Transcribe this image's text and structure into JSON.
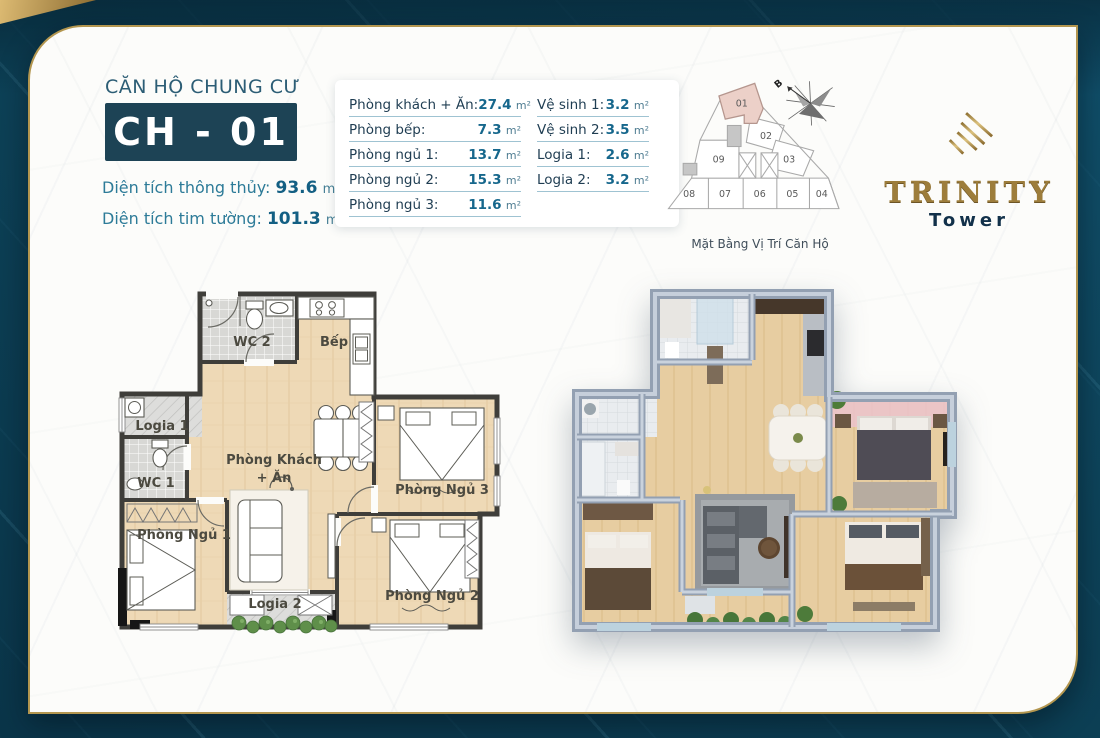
{
  "colors": {
    "background_teal": "#0c3e54",
    "card_white": "#fcfcfa",
    "brand_gold": "#b3964f",
    "navy_badge": "#1d4355",
    "teal_value": "#16678c",
    "navy_label": "#1f3d52",
    "highlight_unit_pink": "#ecd0c8",
    "plan_floor_beige": "#eed9b6",
    "plan_wall_gray": "#3f3e3a",
    "render_wall_blue": "#93a0b2"
  },
  "header": {
    "title": "CĂN HỘ CHUNG CƯ",
    "unit_code": "CH - 01",
    "net_label": "Diện tích thông thủy:",
    "net_value": "93.6",
    "gross_label": "Diện tích tim tường:",
    "gross_value": "101.3",
    "unit": "m²"
  },
  "area_table": {
    "unit": "m²",
    "left": [
      {
        "label": "Phòng khách + Ăn:",
        "value": "27.4"
      },
      {
        "label": "Phòng bếp:",
        "value": "7.3"
      },
      {
        "label": "Phòng ngủ 1:",
        "value": "13.7"
      },
      {
        "label": "Phòng ngủ 2:",
        "value": "15.3"
      },
      {
        "label": "Phòng ngủ 3:",
        "value": "11.6"
      }
    ],
    "right": [
      {
        "label": "Vệ sinh 1:",
        "value": "3.2"
      },
      {
        "label": "Vệ sinh 2:",
        "value": "3.5"
      },
      {
        "label": "Logia 1:",
        "value": "2.6"
      },
      {
        "label": "Logia 2:",
        "value": "3.2"
      }
    ]
  },
  "location_diagram": {
    "caption": "Mặt Bằng Vị Trí Căn Hộ",
    "compass_label": "B",
    "highlighted_unit": "01",
    "units": {
      "u01": "01",
      "u02": "02",
      "u03": "03",
      "u04": "04",
      "u05": "05",
      "u06": "06",
      "u07": "07",
      "u08": "08",
      "u09": "09"
    }
  },
  "logo": {
    "title": "TRINITY",
    "subtitle": "Tower"
  },
  "floorplan_2d": {
    "labels": {
      "wc2": "WC 2",
      "kitchen": "Bếp",
      "logia1": "Logia 1",
      "wc1": "WC 1",
      "living_line1": "Phòng Khách",
      "living_line2": "+ Ăn",
      "bedroom1": "Phòng Ngủ 1",
      "bedroom2": "Phòng Ngủ 2",
      "bedroom3": "Phòng Ngủ 3",
      "logia2": "Logia 2"
    }
  }
}
